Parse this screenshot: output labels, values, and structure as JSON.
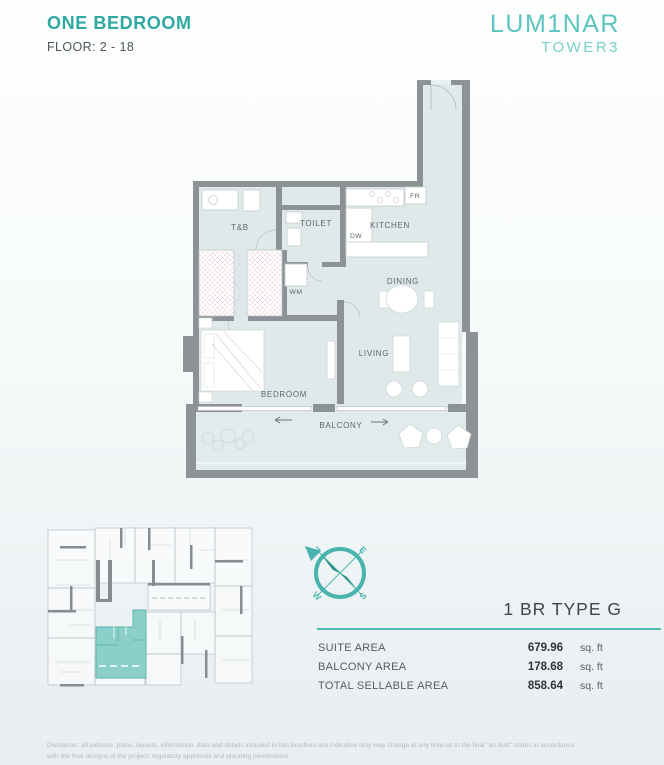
{
  "header": {
    "title": "ONE BEDROOM",
    "floor": "FLOOR: 2 - 18"
  },
  "logo": {
    "name": "LUM1NAR",
    "tower": "TOWER3"
  },
  "floor_plan": {
    "rooms": {
      "tb": "T&B",
      "toilet": "TOILET",
      "kitchen": "KITCHEN",
      "dining": "DINING",
      "living": "LIVING",
      "bedroom": "BEDROOM",
      "balcony": "BALCONY"
    },
    "appliances": {
      "fr": "FR",
      "dw": "DW",
      "wm": "WM"
    }
  },
  "key_plan": {
    "description": "floor plate key plan with unit highlighted"
  },
  "compass": {
    "n": "N",
    "e": "E",
    "s": "S",
    "w": "W"
  },
  "unit_info": {
    "type_label": "1 BR TYPE G",
    "rows": [
      {
        "label": "SUITE AREA",
        "value": "679.96",
        "unit": "sq. ft"
      },
      {
        "label": "BALCONY AREA",
        "value": "178.68",
        "unit": "sq. ft"
      },
      {
        "label": "TOTAL SELLABLE AREA",
        "value": "858.64",
        "unit": "sq. ft"
      }
    ]
  },
  "disclaimer": {
    "line1": "Disclaimer: all pictures, plans, layouts, information, data and details included in this brochure are indicative only may change at any time up to the final \"as built\" status in accordance",
    "line2": "with the final designs of the project, regulatory approvals and planning permissions"
  },
  "colors": {
    "accent": "#2fa9a2",
    "logo_teal": "#5cc5bf",
    "wall_gray": "#8d9297",
    "floor_fill": "#dfe9ea",
    "highlight_teal": "#8bcfc9",
    "divider_teal": "#50b9b2"
  }
}
